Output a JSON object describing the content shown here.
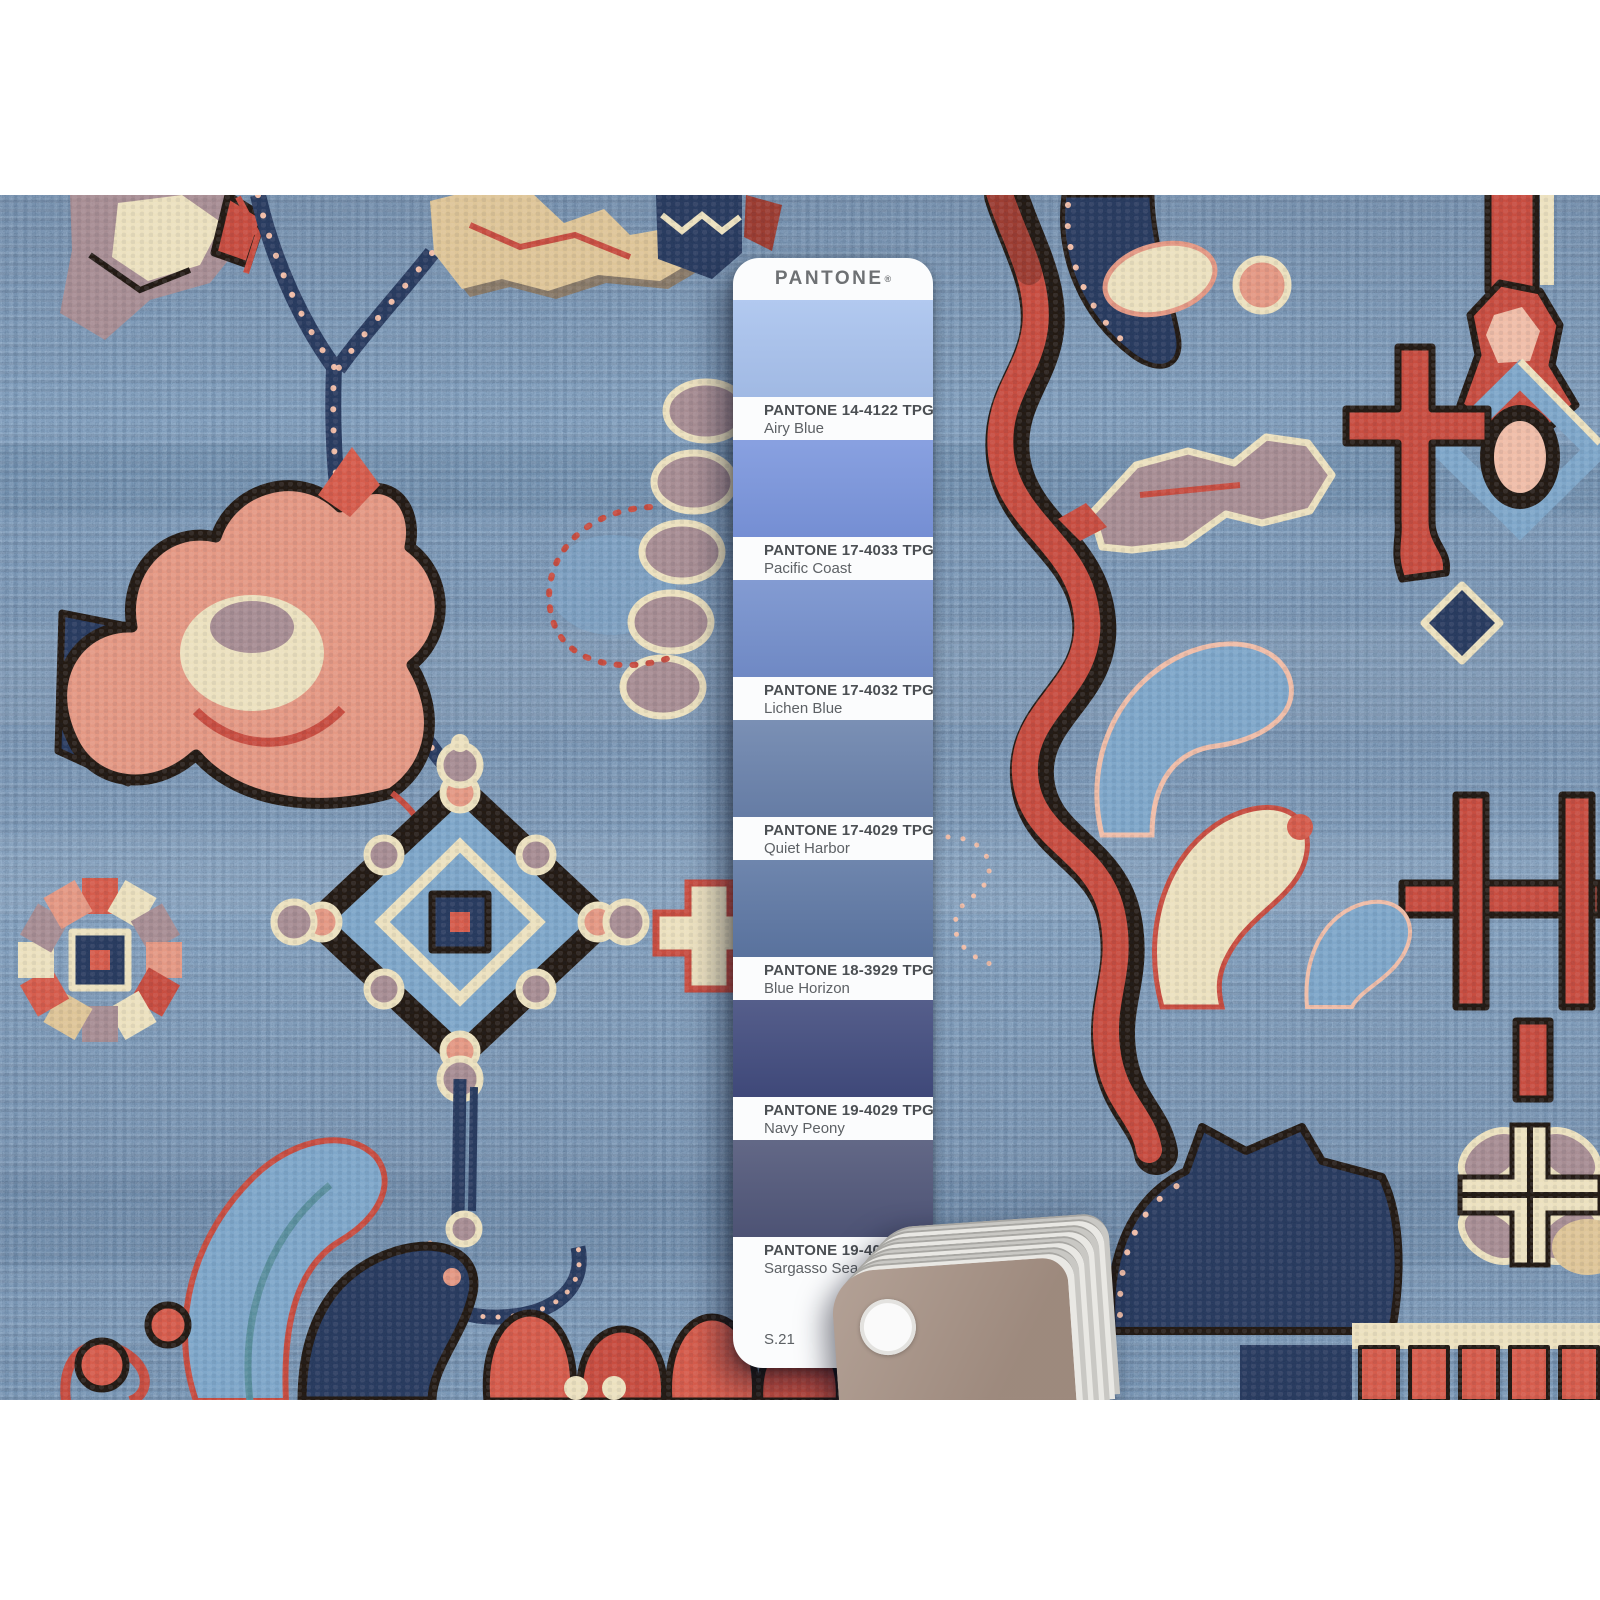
{
  "scene": {
    "description": "Close-up photograph of a hand-knotted denim-blue wool oriental rug with red, salmon, cream, mauve and navy tribal motifs. A PANTONE TPG fan-guide strip of seven blue swatches lies on the rug; the fanned deck and taupe back card with a white rivet are visible at the lower right."
  },
  "pantone_card": {
    "brand": "PANTONE",
    "trademark": "®",
    "page_code": "S.21",
    "swatches": [
      {
        "code": "PANTONE 14-4122 TPG",
        "name": "Airy Blue",
        "color": "#a9c3ee"
      },
      {
        "code": "PANTONE 17-4033 TPG",
        "name": "Pacific Coast",
        "color": "#7b96dd"
      },
      {
        "code": "PANTONE 17-4032 TPG",
        "name": "Lichen Blue",
        "color": "#7590cd"
      },
      {
        "code": "PANTONE 17-4029 TPG",
        "name": "Quiet Harbor",
        "color": "#6b83ac"
      },
      {
        "code": "PANTONE 18-3929 TPG",
        "name": "Blue Horizon",
        "color": "#5e78a4"
      },
      {
        "code": "PANTONE 19-4029 TPG",
        "name": "Navy Peony",
        "color": "#424c7e"
      },
      {
        "code": "PANTONE 19-4024 TPG",
        "name": "Sargasso Sea",
        "color": "#515779"
      }
    ]
  },
  "palette": {
    "field": "#3e6e9c",
    "field_light": "#6f9ac0",
    "navy": "#1b2a4c",
    "navy_deep": "#14203c",
    "red": "#bf3b2d",
    "red_bright": "#cf4a38",
    "red_dark": "#8e2b20",
    "salmon": "#e08a72",
    "salmon_light": "#edb39a",
    "cream": "#e9dcb4",
    "tan": "#d9bc88",
    "mauve": "#9b7e83",
    "black": "#17100b",
    "card_white": "#fbfcfd",
    "label_text": "#4b4f53",
    "name_text": "#5d6165",
    "header_text": "#6e7174",
    "fan_tan": "#a79285"
  }
}
